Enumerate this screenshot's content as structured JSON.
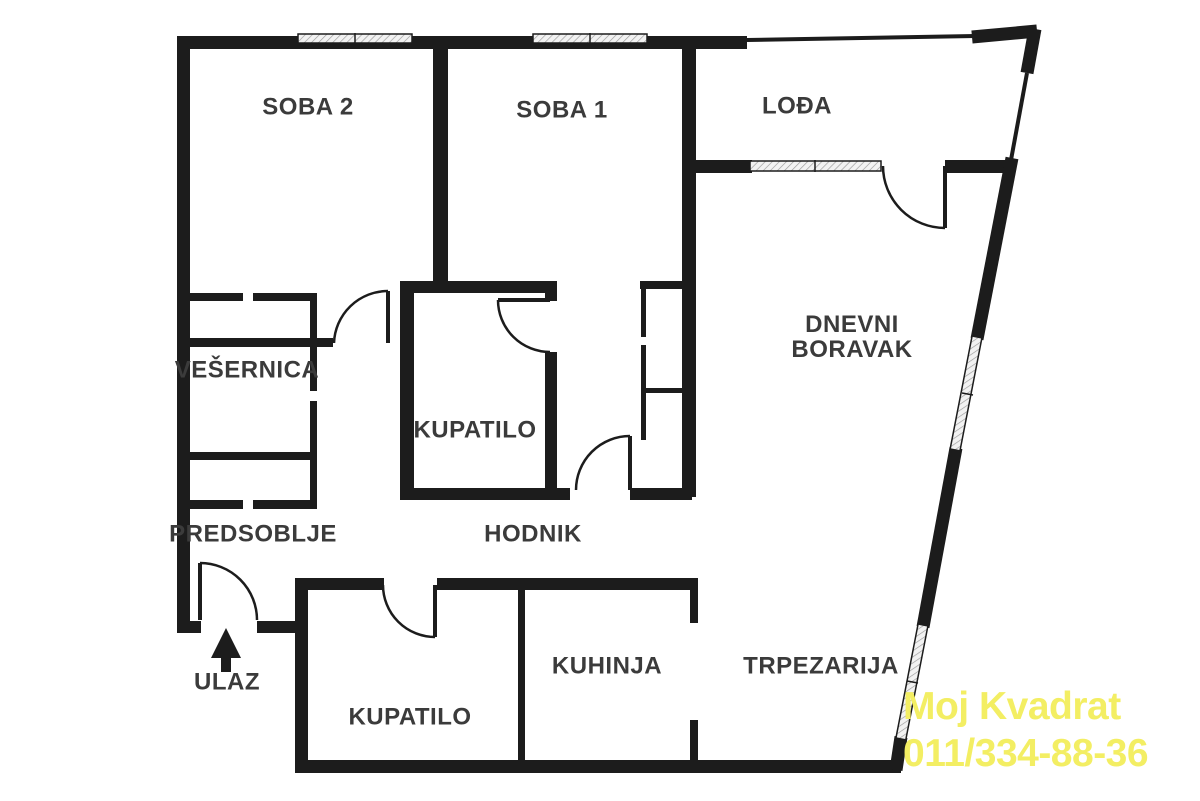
{
  "colors": {
    "wall": "#1c1c1c",
    "label_text": "#3b3b3b",
    "background": "#ffffff",
    "watermark_yellow": "#f3ee63",
    "window_fill": "#f2f2f2",
    "window_hatch": "#9a9a9a"
  },
  "rooms": {
    "soba2": {
      "label": "SOBA 2"
    },
    "soba1": {
      "label": "SOBA 1"
    },
    "lodja": {
      "label": "LOĐA"
    },
    "dnevni_boravak": {
      "label_line1": "DNEVNI",
      "label_line2": "BORAVAK"
    },
    "vesernica": {
      "label": "VEŠERNICA"
    },
    "kupatilo_gornje": {
      "label": "KUPATILO"
    },
    "hodnik": {
      "label": "HODNIK"
    },
    "predsoblje": {
      "label": "PREDSOBLJE"
    },
    "kupatilo_donje": {
      "label": "KUPATILO"
    },
    "kuhinja": {
      "label": "KUHINJA"
    },
    "trpezarija": {
      "label": "TRPEZARIJA"
    }
  },
  "entrance": {
    "label": "ULAZ",
    "icon": "entry-arrow-icon"
  },
  "watermark": {
    "line1": "Moj Kvadrat",
    "line2": "011/334-88-36"
  }
}
